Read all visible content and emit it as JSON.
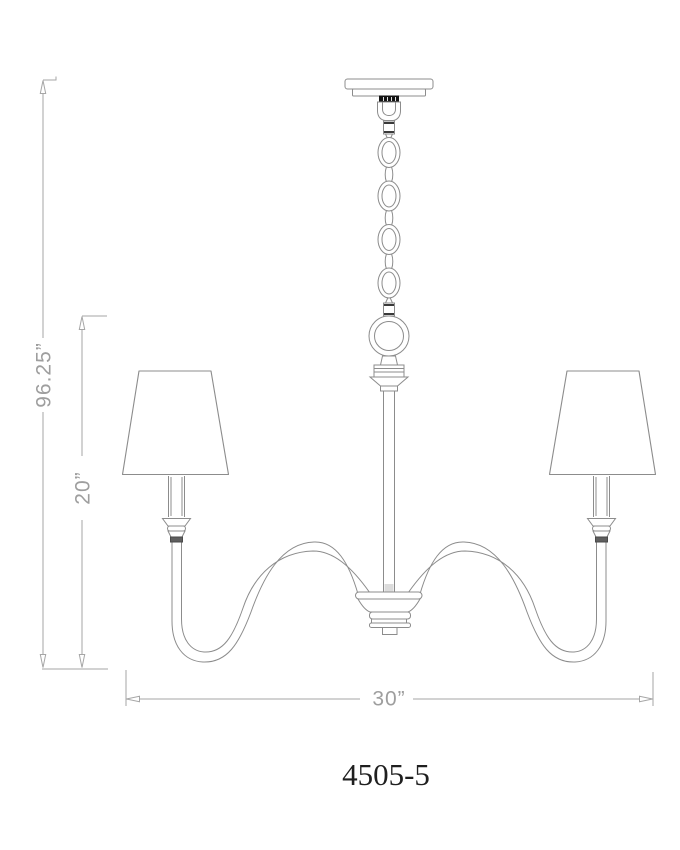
{
  "diagram": {
    "model_number": "4505-5",
    "dimensions": {
      "overall_height": "96.25”",
      "fixture_height": "20”",
      "width": "30”"
    },
    "colors": {
      "background": "#ffffff",
      "fixture_line": "#8c8c8c",
      "dimension_line": "#a6a6a6",
      "dimension_text": "#9e9e9e",
      "model_text": "#1f1f1f",
      "canopy_collar": "#141414"
    }
  }
}
